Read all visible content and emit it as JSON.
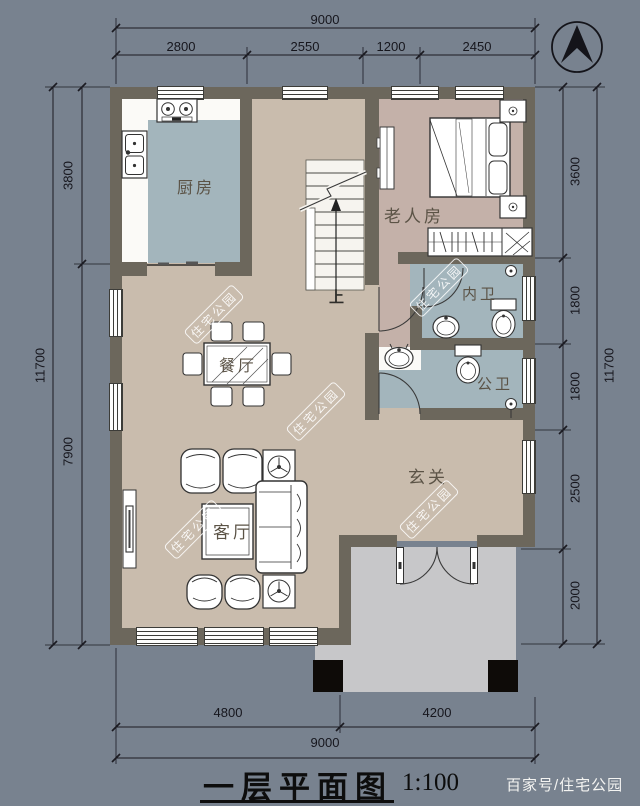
{
  "title": {
    "name": "一层平面图",
    "scale": "1:100"
  },
  "credit": "百家号/住宅公园",
  "watermark": "住宅公园",
  "compass": {
    "icon": "north-arrow"
  },
  "rooms": {
    "kitchen": "厨房",
    "dining": "餐厅",
    "living": "客厅",
    "entry": "玄关",
    "elder_bedroom": "老人房",
    "inner_bath": "内卫",
    "public_bath": "公卫",
    "stairs_up": "上"
  },
  "dimensions": {
    "top": {
      "total": "9000",
      "segments": [
        "2800",
        "2550",
        "1200",
        "2450"
      ]
    },
    "bottom": {
      "total": "9000",
      "segments": [
        "4800",
        "4200"
      ]
    },
    "left": {
      "total": "11700",
      "segments": [
        "3800",
        "7900"
      ]
    },
    "right": {
      "total": "11700",
      "segments": [
        "3600",
        "1800",
        "1800",
        "2500",
        "2000"
      ]
    }
  },
  "colors": {
    "bg": "#78828f",
    "wall": "#6c675c",
    "floor_main": "#c9bcad",
    "floor_bedroom": "#c4b1a9",
    "floor_wet": "#a3b5bc",
    "porch": "#c7c7c9",
    "column": "#0e0b08"
  }
}
